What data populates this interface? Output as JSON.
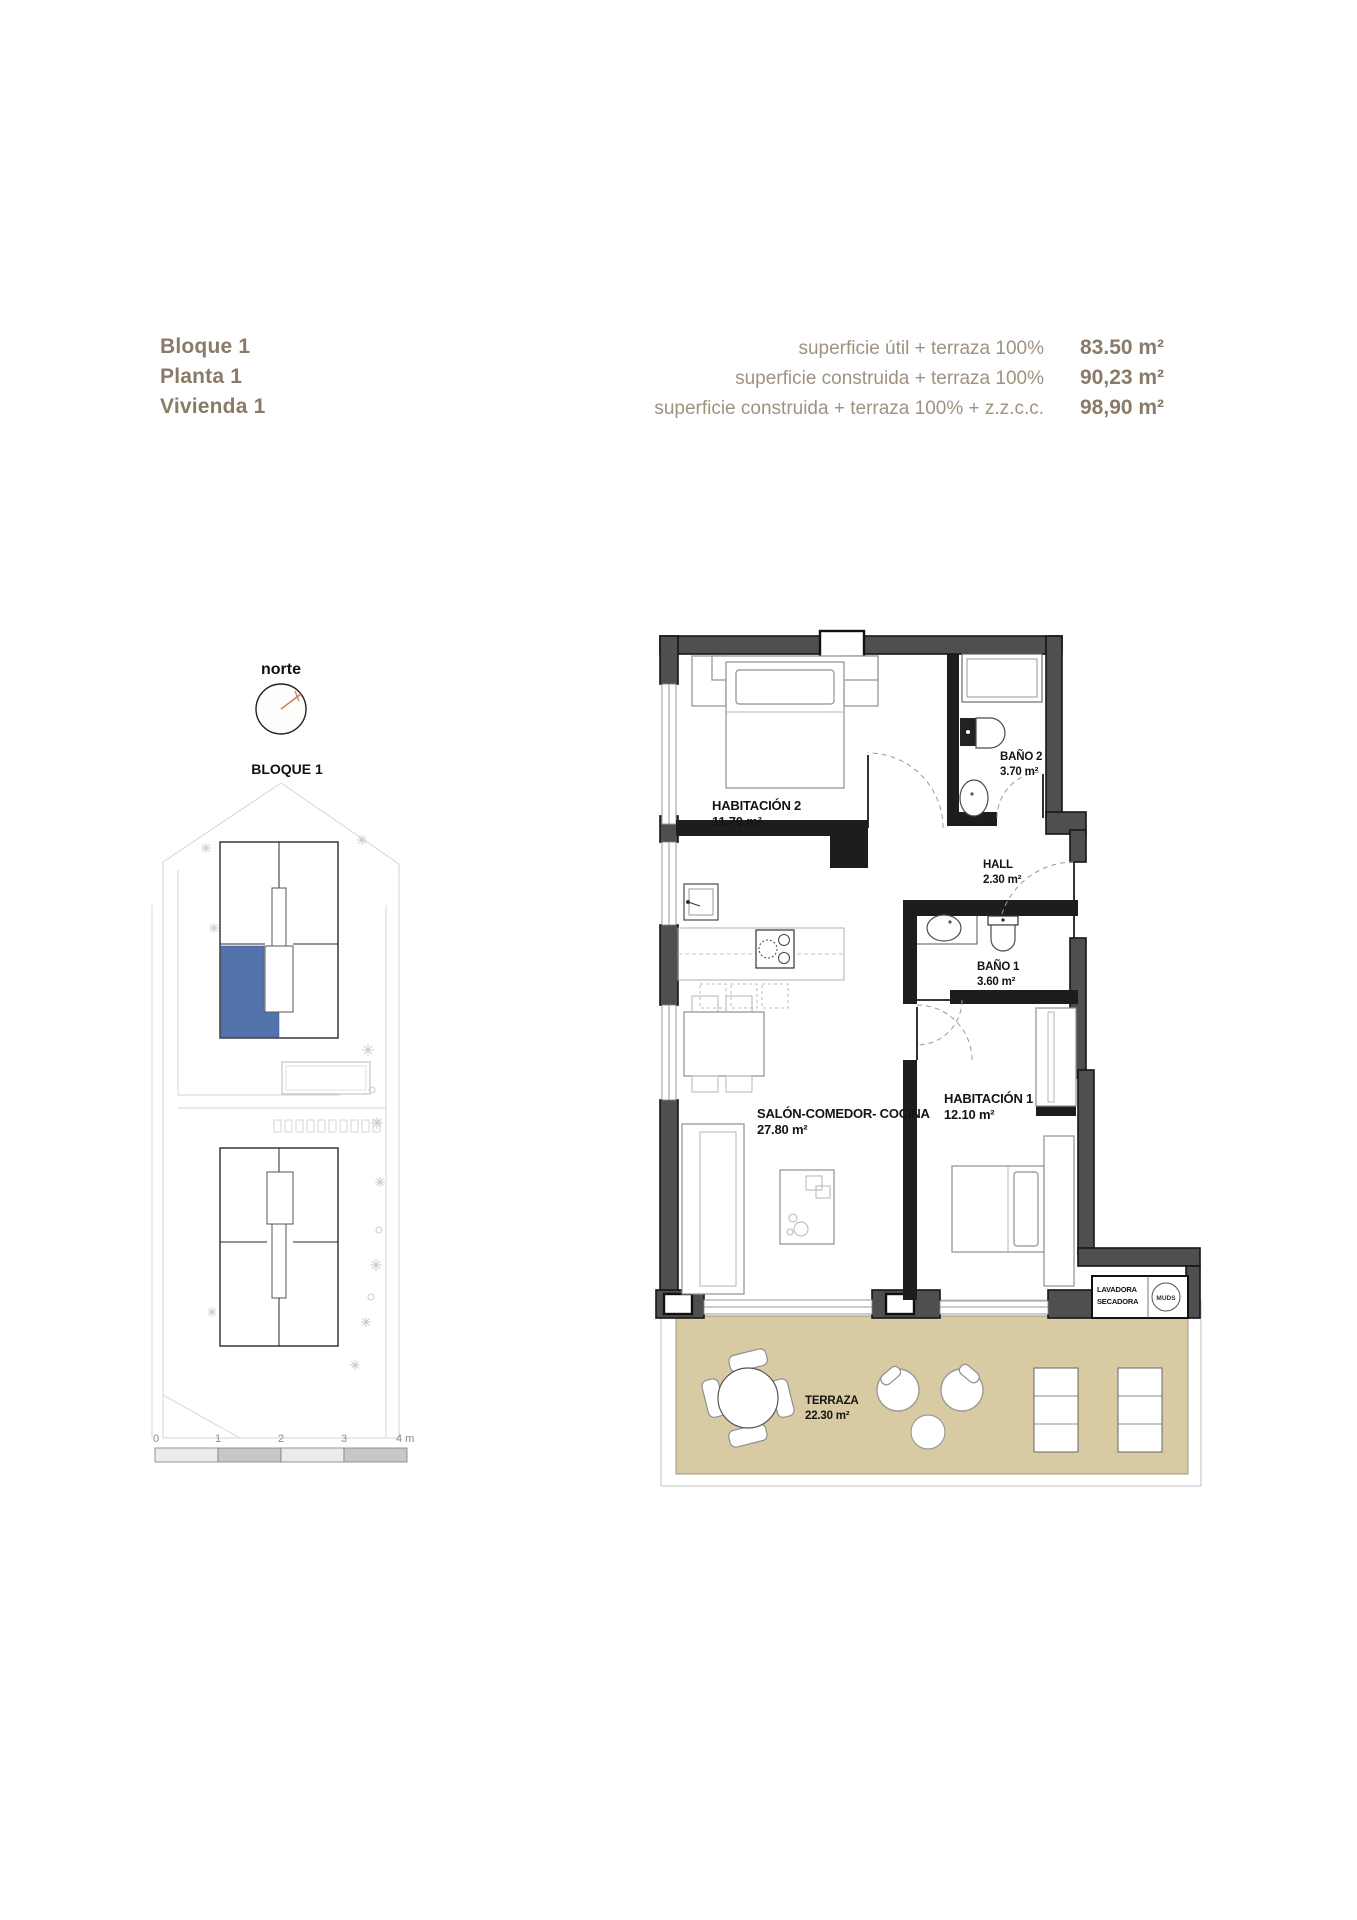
{
  "header": {
    "block": "Bloque 1",
    "floor": "Planta 1",
    "dwelling": "Vivienda 1",
    "areas": [
      {
        "label": "superficie útil + terraza 100%",
        "value": "83.50 m²"
      },
      {
        "label": "superficie construida + terraza 100%",
        "value": "90,23 m²"
      },
      {
        "label": "superficie construida + terraza 100% + z.z.c.c.",
        "value": "98,90 m²"
      }
    ]
  },
  "sitemap": {
    "north_label": "norte",
    "block_label": "BLOQUE 1",
    "highlight_color": "#5373ad"
  },
  "scalebar": {
    "ticks": [
      "0",
      "1",
      "2",
      "3"
    ],
    "end_label": "4 m"
  },
  "plan": {
    "rooms": [
      {
        "name": "HABITACIÓN 2",
        "area": "11.70 m²"
      },
      {
        "name": "BAÑO 2",
        "area": "3.70 m²"
      },
      {
        "name": "HALL",
        "area": "2.30 m²"
      },
      {
        "name": "BAÑO 1",
        "area": "3.60 m²"
      },
      {
        "name": "SALÓN-COMEDOR- COCINA",
        "area": "27.80 m²"
      },
      {
        "name": "HABITACIÓN 1",
        "area": "12.10 m²"
      },
      {
        "name": "TERRAZA",
        "area": "22.30 m²"
      }
    ],
    "laundry": {
      "line1": "LAVADORA",
      "line2": "SECADORA",
      "tag": "MUDS"
    },
    "colors": {
      "terrace": "#d8cba4",
      "wall": "#4f4f4f"
    }
  }
}
